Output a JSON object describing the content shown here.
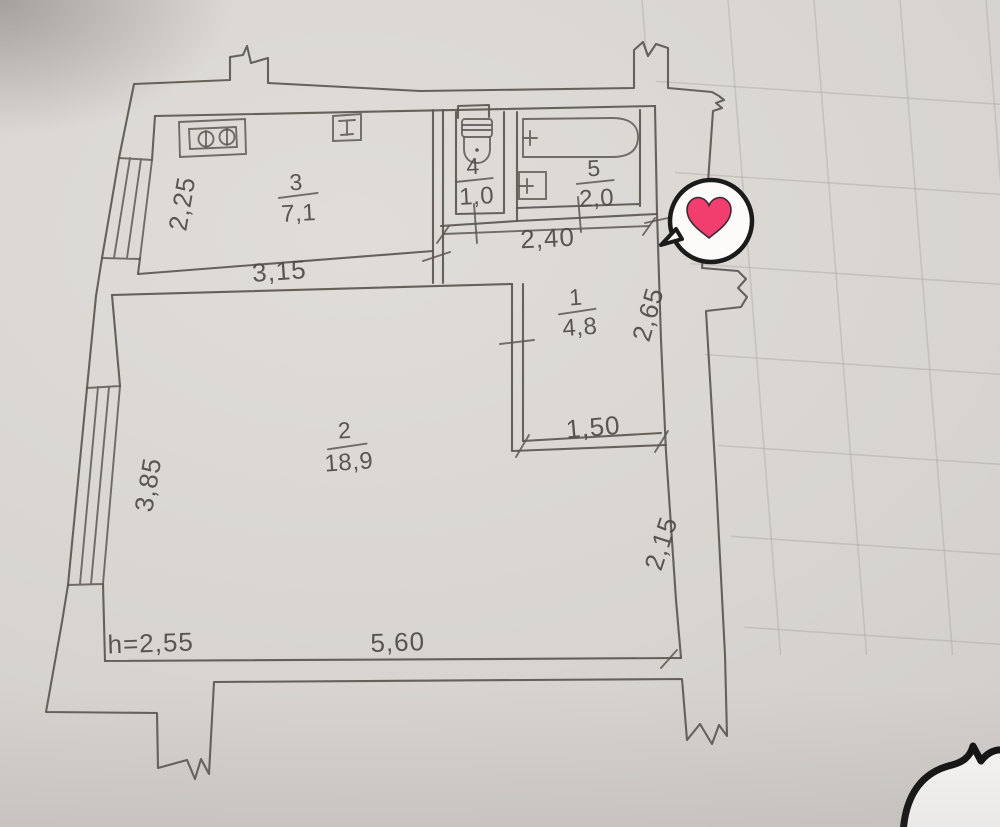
{
  "photo": {
    "type": "apartment-floor-plan-photo",
    "paper_color": "#d8d5d1",
    "ink_color": "#5d5751"
  },
  "floor_plan": {
    "rooms": [
      {
        "number": "3",
        "area": "7,1"
      },
      {
        "number": "4",
        "area": "1,0"
      },
      {
        "number": "5",
        "area": "2,0"
      },
      {
        "number": "1",
        "area": "4,8"
      },
      {
        "number": "2",
        "area": "18,9"
      }
    ],
    "dimensions": {
      "kitchen_left_height": "2,25",
      "kitchen_bottom_width": "3,15",
      "corridor_top_width": "2,40",
      "corridor_right_height": "2,65",
      "hall_step_width": "1,50",
      "room2_right_height": "2,15",
      "room2_left_window_height": "3,85",
      "room2_bottom_width": "5,60",
      "ceiling_height": "h=2,55"
    },
    "fixtures": [
      "stove-icon",
      "vent-icon",
      "toilet-icon",
      "bathtub-icon",
      "sink-icon"
    ]
  },
  "stickers": {
    "heart_bubble": {
      "icon": "heart-icon",
      "heart_color": "#f23e6e",
      "bubble_color": "#fcfbf9",
      "outline_color": "#1b1b1b"
    },
    "corner_bubble": {
      "icon": "speech-bubble-icon",
      "bubble_color": "#fbfaf8",
      "outline_color": "#111111"
    }
  }
}
